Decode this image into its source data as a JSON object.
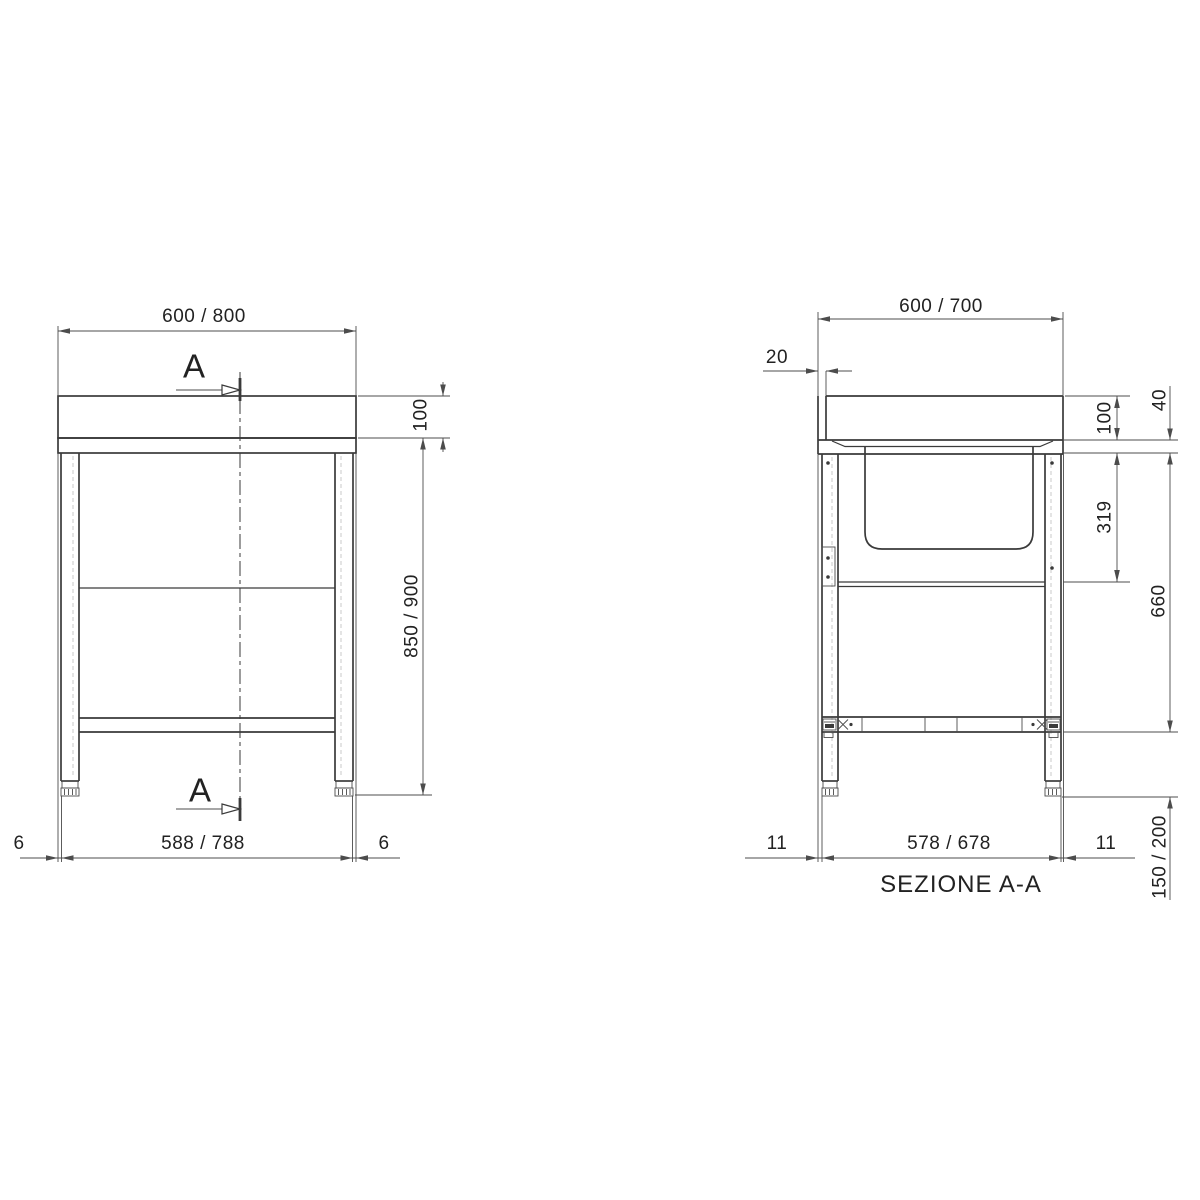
{
  "colors": {
    "background": "#ffffff",
    "line": "#3a3a3a",
    "dim_line": "#4c4c4c",
    "text": "#222222"
  },
  "front_view": {
    "width_top": "600 / 800",
    "section_letter_top": "A",
    "section_letter_bottom": "A",
    "upstand_height": "100",
    "height": "850 / 900",
    "overhang_left": "6",
    "overhang_right": "6",
    "width_bottom": "588 / 788"
  },
  "section_view": {
    "title": "SEZIONE A-A",
    "depth_top": "600 / 700",
    "upstand_thickness": "20",
    "upstand_height": "100",
    "worktop_thickness": "40",
    "bowl_depth": "319",
    "frame_height": "660",
    "clearance_height": "150 / 200",
    "inset_left": "11",
    "inset_right": "11",
    "depth_bottom": "578 / 678"
  }
}
